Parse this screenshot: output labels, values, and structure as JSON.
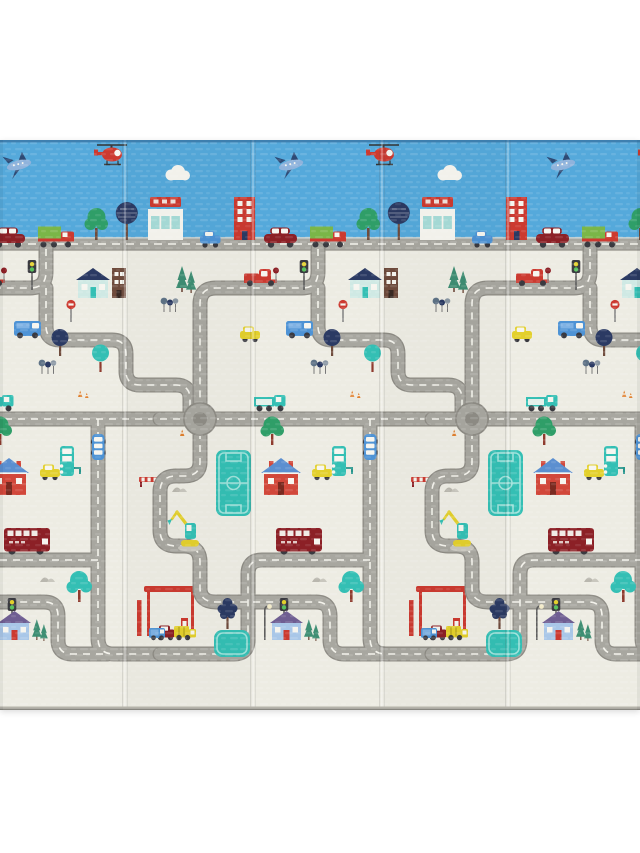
{
  "image": {
    "type": "product-photo",
    "subject": "Foldable baby play mat with cartoon city road-map print, photographed on a white background",
    "panels": 5,
    "fold_lines": 4,
    "visible_text": "none"
  },
  "palette": {
    "sky": "#55A9DB",
    "skyTrim": "#2E5E8C",
    "cream": "#EDECE3",
    "matEdge": "#B5B3AA",
    "road": "#A8A7A0",
    "roadEdge": "#8E8C85",
    "roadLight": "#D9D8D0",
    "roadDash": "#F4F3EC",
    "roundCenter": "#8F8D86",
    "red": "#CC3A30",
    "busRed": "#8C2026",
    "houseRed": "#D1473A",
    "green": "#2F9E68",
    "pine": "#3E8E73",
    "cargoGreen": "#7AB648",
    "teal": "#34BFB4",
    "tealDark": "#27958C",
    "fieldLine": "#9FE2DB",
    "paleTeal": "#CFE9E4",
    "tealGlass": "#A7DCD8",
    "navy": "#2B3A63",
    "blue": "#4E93D5",
    "blueLight": "#7FB2E4",
    "glass": "#CFE4F2",
    "roofBlue": "#5B8FD0",
    "purple": "#6F5E92",
    "houseBlue": "#A9C7E8",
    "yellow": "#E3D02C",
    "yellowDark": "#B8A81F",
    "orange": "#E0812F",
    "brown": "#6F4B3C",
    "rust": "#8E3B2E",
    "slate": "#5E7286",
    "grayTree": "#8A97A3",
    "white": "#F6F5EF",
    "gray": "#B9B7AE",
    "grayLight": "#C9C7BE",
    "dark": "#3A3A40",
    "steel": "#8FB3DC",
    "steelDark": "#2D4A75",
    "pole": "#5E5E5E",
    "lamp": "#F2EAC8"
  },
  "motifs": [
    "airplane",
    "helicopter",
    "cloud",
    "tall red building",
    "shop with red sign",
    "round trees",
    "green trees",
    "pine trees",
    "city road band",
    "blue car",
    "dark red sedan",
    "truck with green cargo",
    "red pickup truck",
    "yellow car",
    "blue van",
    "teal flatbed truck",
    "red single-deck bus",
    "vertical blue minibus",
    "teal forklift truck",
    "soccer field",
    "teal pool",
    "red house with blue roof",
    "blue house with purple roof",
    "teal house",
    "brown building",
    "roundabout",
    "winding gray roads with white dashes",
    "traffic lights",
    "stop sign",
    "road barrier",
    "excavator",
    "gas station with red canopy",
    "garbage truck",
    "small blue van",
    "street lamp",
    "gray mountains",
    "traffic cones",
    "fold creases"
  ]
}
